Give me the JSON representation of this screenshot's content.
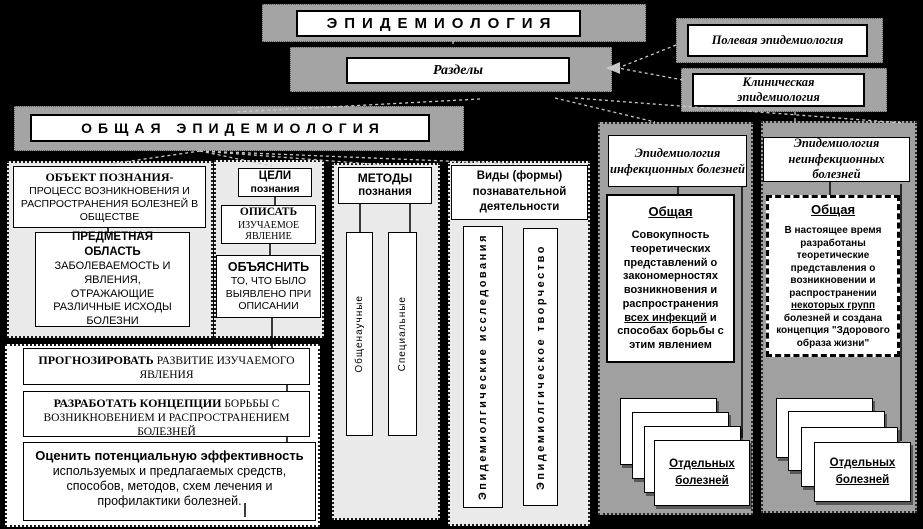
{
  "diagram": {
    "title": "ЭПИДЕМИОЛОГИЯ",
    "sections_label": "Разделы",
    "branches": {
      "field": "Полевая эпидемиология",
      "clinical": "Клиническая эпидемиология",
      "general": "ОБЩАЯ  ЭПИДЕМИОЛОГИЯ"
    },
    "object_box": {
      "title": "ОБЪЕКТ  ПОЗНАНИЯ-",
      "body": "ПРОЦЕСС ВОЗНИКНОВЕНИЯ И РАСПРОСТРАНЕНИЯ БОЛЕЗНЕЙ В ОБЩЕСТВЕ"
    },
    "subject_box": {
      "title": "ПРЕДМЕТНАЯ ОБЛАСТЬ",
      "body": "ЗАБОЛЕВАЕМОСТЬ И ЯВЛЕНИЯ, ОТРАЖАЮЩИЕ РАЗЛИЧНЫЕ ИСХОДЫ БОЛЕЗНИ"
    },
    "goals_box": {
      "title": "ЦЕЛИ",
      "subtitle": "познания"
    },
    "describe_box": {
      "title": "ОПИСАТЬ",
      "body": "ИЗУЧАЕМОЕ ЯВЛЕНИЕ"
    },
    "explain_box": {
      "title": "ОБЪЯСНИТЬ",
      "body": "ТО, ЧТО БЫЛО ВЫЯВЛЕНО ПРИ ОПИСАНИИ"
    },
    "forecast_box": {
      "title": "ПРОГНОЗИРОВАТЬ ",
      "body": "РАЗВИТИЕ ИЗУЧАЕМОГО ЯВЛЕНИЯ"
    },
    "develop_box": {
      "title": "РАЗРАБОТАТЬ КОНЦЕПЦИИ ",
      "body": "БОРЬБЫ С ВОЗНИКНОВЕНИЕМ И РАСПРОСТРАНЕНИЕМ БОЛЕЗНЕЙ"
    },
    "evaluate_box": {
      "title": "Оценить потенциальную эффективность ",
      "body": "используемых и предлагаемых средств, способов, методов, схем  лечения и профилактики болезней."
    },
    "methods": {
      "title": "МЕТОДЫ",
      "subtitle": "познания",
      "items": [
        "Общенаучные",
        "Специальные"
      ]
    },
    "forms": {
      "title": "Виды (формы) познавательной деятельности",
      "items": [
        "Эпидемиолгические исследования",
        "Эпидемиолгическое творчество"
      ]
    },
    "infectious": {
      "title": "Эпидемиология инфекционных болезней",
      "general_title": "Общая",
      "body_1": "Совокупность теоретических представлений о закономерностях возникновения и распространения ",
      "body_u": "всех инфекций",
      "body_2": " и способах борьбы с этим явлением",
      "cards_label": "Отдельных болезней"
    },
    "noninfectious": {
      "title": "Эпидемиология неинфекционных болезней",
      "general_title": "Общая",
      "body_1": "В настоящее время разработаны теоретические представления о возникновении и распространении ",
      "body_u": "некоторых групп",
      "body_2": " болезней и создана концепция \"Здорового образа жизни\"",
      "cards_label": "Отдельных болезней"
    },
    "colors": {
      "background": "#000000",
      "panel_gray": "#a0a0a0",
      "panel_light": "#eaeaea",
      "box_white": "#ffffff"
    }
  }
}
